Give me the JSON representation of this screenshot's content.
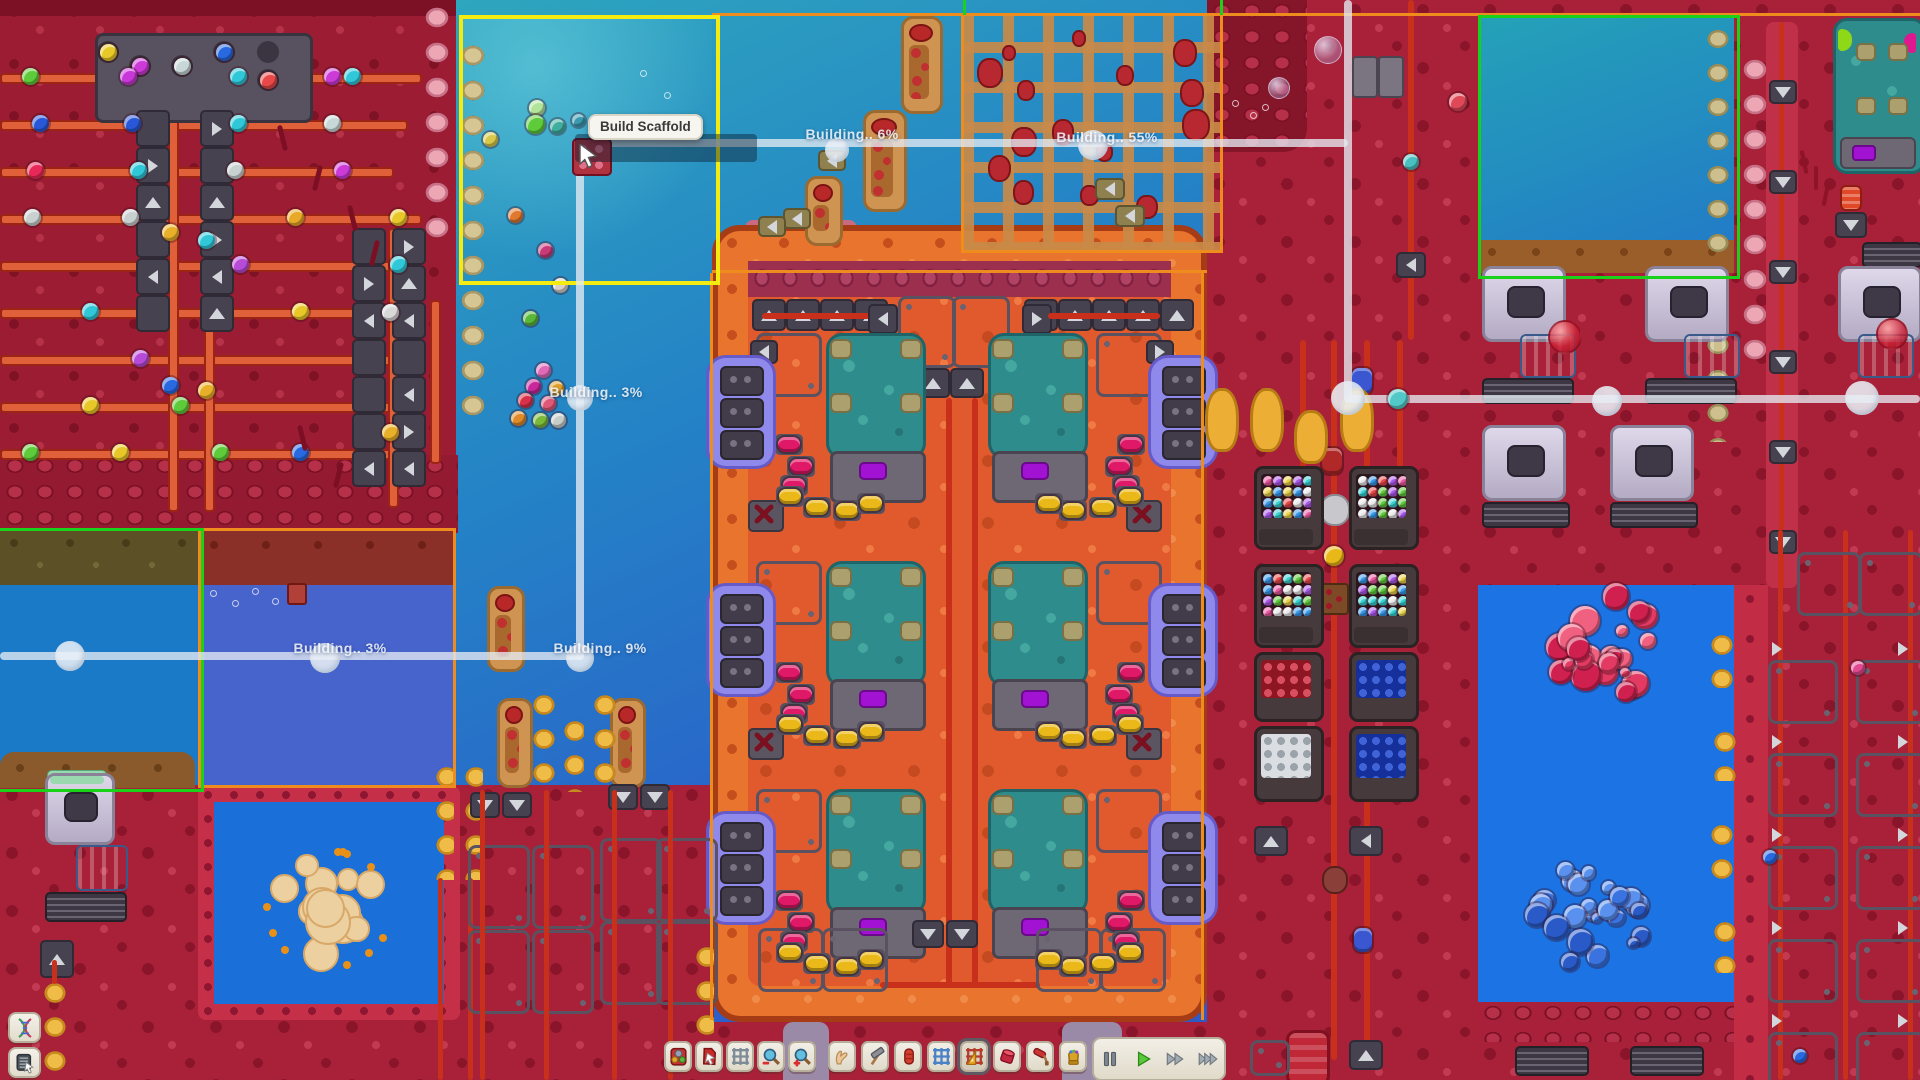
{
  "hud": {
    "tooltip": "Build Scaffold",
    "build_labels": [
      {
        "id": "label-water-top",
        "text": "Building.. 6%"
      },
      {
        "id": "label-scaffold",
        "text": "Building.. 55%"
      },
      {
        "id": "label-water-mid",
        "text": "Building.. 3%"
      },
      {
        "id": "label-pool-left",
        "text": "Building.. 3%"
      },
      {
        "id": "label-pool-mid",
        "text": "Building.. 9%"
      }
    ]
  },
  "toolbar": {
    "tools": [
      {
        "icon": "orb-machine-icon",
        "name": "overlay-resources-button",
        "selected": false
      },
      {
        "icon": "pointer-bag-icon",
        "name": "select-tool-button",
        "selected": false
      },
      {
        "icon": "grid-gray-icon",
        "name": "grid-toggle-button",
        "selected": false
      },
      {
        "icon": "zoom-out-icon",
        "name": "zoom-out-button",
        "selected": false
      },
      {
        "icon": "zoom-in-icon",
        "name": "zoom-in-button",
        "selected": false
      },
      {
        "icon": "hand-icon",
        "name": "pan-tool-button",
        "selected": false
      },
      {
        "icon": "hammer-icon",
        "name": "build-tool-button",
        "selected": false
      },
      {
        "icon": "pipe-icon",
        "name": "pipe-tool-button",
        "selected": false
      },
      {
        "icon": "grid-blue-icon",
        "name": "conveyor-tool-button",
        "selected": false
      },
      {
        "icon": "ruler-grid-icon",
        "name": "scaffold-tool-button",
        "selected": true
      },
      {
        "icon": "cylinder-icon",
        "name": "tank-tool-button",
        "selected": false
      },
      {
        "icon": "paint-roller-icon",
        "name": "paint-tool-button",
        "selected": false
      },
      {
        "icon": "gauntlet-icon",
        "name": "gauntlet-tool-button",
        "selected": false
      }
    ],
    "playback": [
      {
        "icon": "pause-icon",
        "name": "pause-button",
        "active": false
      },
      {
        "icon": "play-icon",
        "name": "play-button",
        "active": true
      },
      {
        "icon": "fast-forward-icon",
        "name": "fast-forward-button",
        "active": false
      },
      {
        "icon": "fastest-forward-icon",
        "name": "fastest-forward-button",
        "active": false
      }
    ]
  },
  "corner_buttons": [
    {
      "icon": "dna-icon",
      "name": "research-button"
    },
    {
      "icon": "list-icon",
      "name": "orders-button"
    }
  ],
  "colors": {
    "selection_yellow": "#f4ec10",
    "selection_green": "#1ad21a",
    "zone_orange": "#ef8c1e",
    "network_line": "#e4ebf2",
    "water_blue": "#2576c8",
    "terrain_crimson": "#a92138",
    "factory_orange": "#e8742e",
    "machine_teal": "#2f8c8c",
    "tank_purple": "#8f86ea",
    "toolbar_beige": "#ece7dc"
  }
}
